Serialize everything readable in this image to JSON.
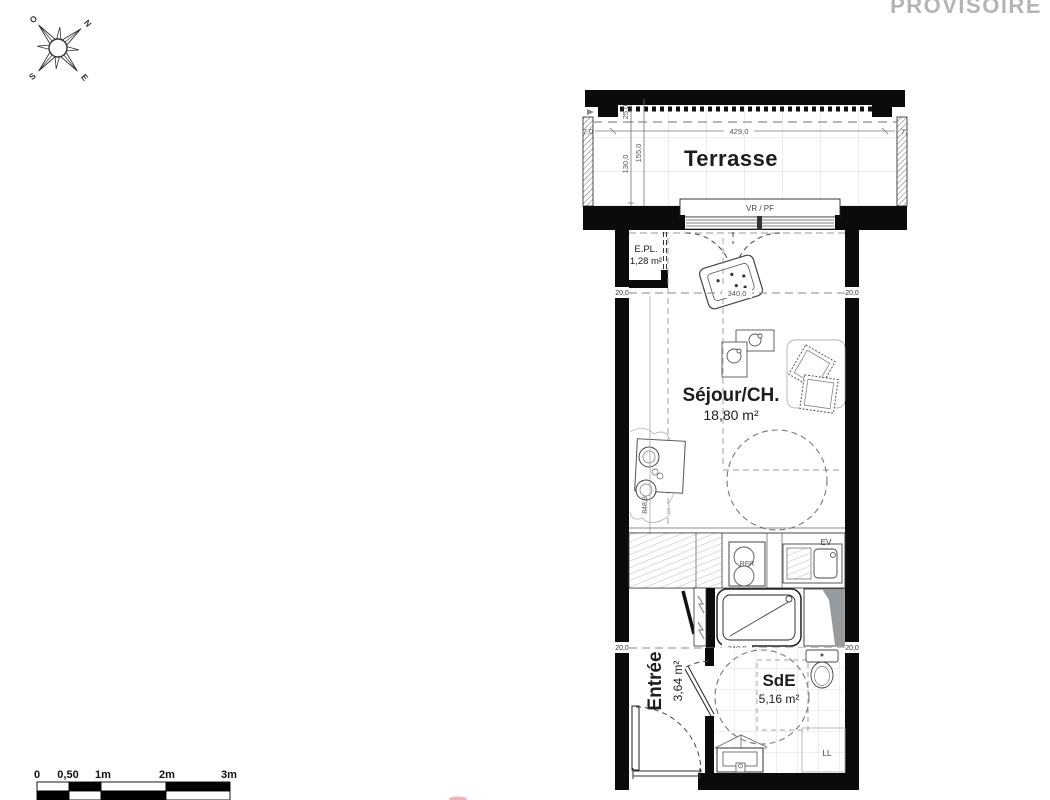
{
  "watermark": "PROVISOIRE",
  "colors": {
    "wall": "#0b0b0b",
    "watermark_gray": "#b3b6b8",
    "duct_gray": "#969a9d",
    "tile_line": "#cdd0d2",
    "accent_red": "#e59aa2"
  },
  "compass": {
    "west": "O",
    "north": "N",
    "south": "S",
    "east": "E"
  },
  "rooms": {
    "terrasse": {
      "name": "Terrasse"
    },
    "epl": {
      "name": "E.PL.",
      "area": "1,28 m²"
    },
    "sejour": {
      "name": "Séjour/CH.",
      "area": "18,80 m²"
    },
    "entree": {
      "name": "Entrée",
      "area": "3,64 m²"
    },
    "sde": {
      "name": "SdE",
      "area": "5,16 m²"
    }
  },
  "fixtures": {
    "window_label": "VR / PF",
    "fridge": "RFR",
    "sink": "EV",
    "washer": "LL"
  },
  "dimensions": {
    "terrace": {
      "left_offset": "7,0",
      "width": "429,0",
      "right_offset": "7,",
      "depth_a": "25,0",
      "depth_b": "130,0",
      "depth_c": "155,0"
    },
    "sejour": {
      "wall_left": "20,0",
      "width": "340,0",
      "wall_right": "20,0",
      "length": "848,9"
    },
    "sde": {
      "wall_left": "20,0",
      "width": "340,0",
      "wall_right": "20,0"
    }
  },
  "scale_bar": {
    "ticks": [
      "0",
      "0,50",
      "1m",
      "2m",
      "3m"
    ]
  }
}
